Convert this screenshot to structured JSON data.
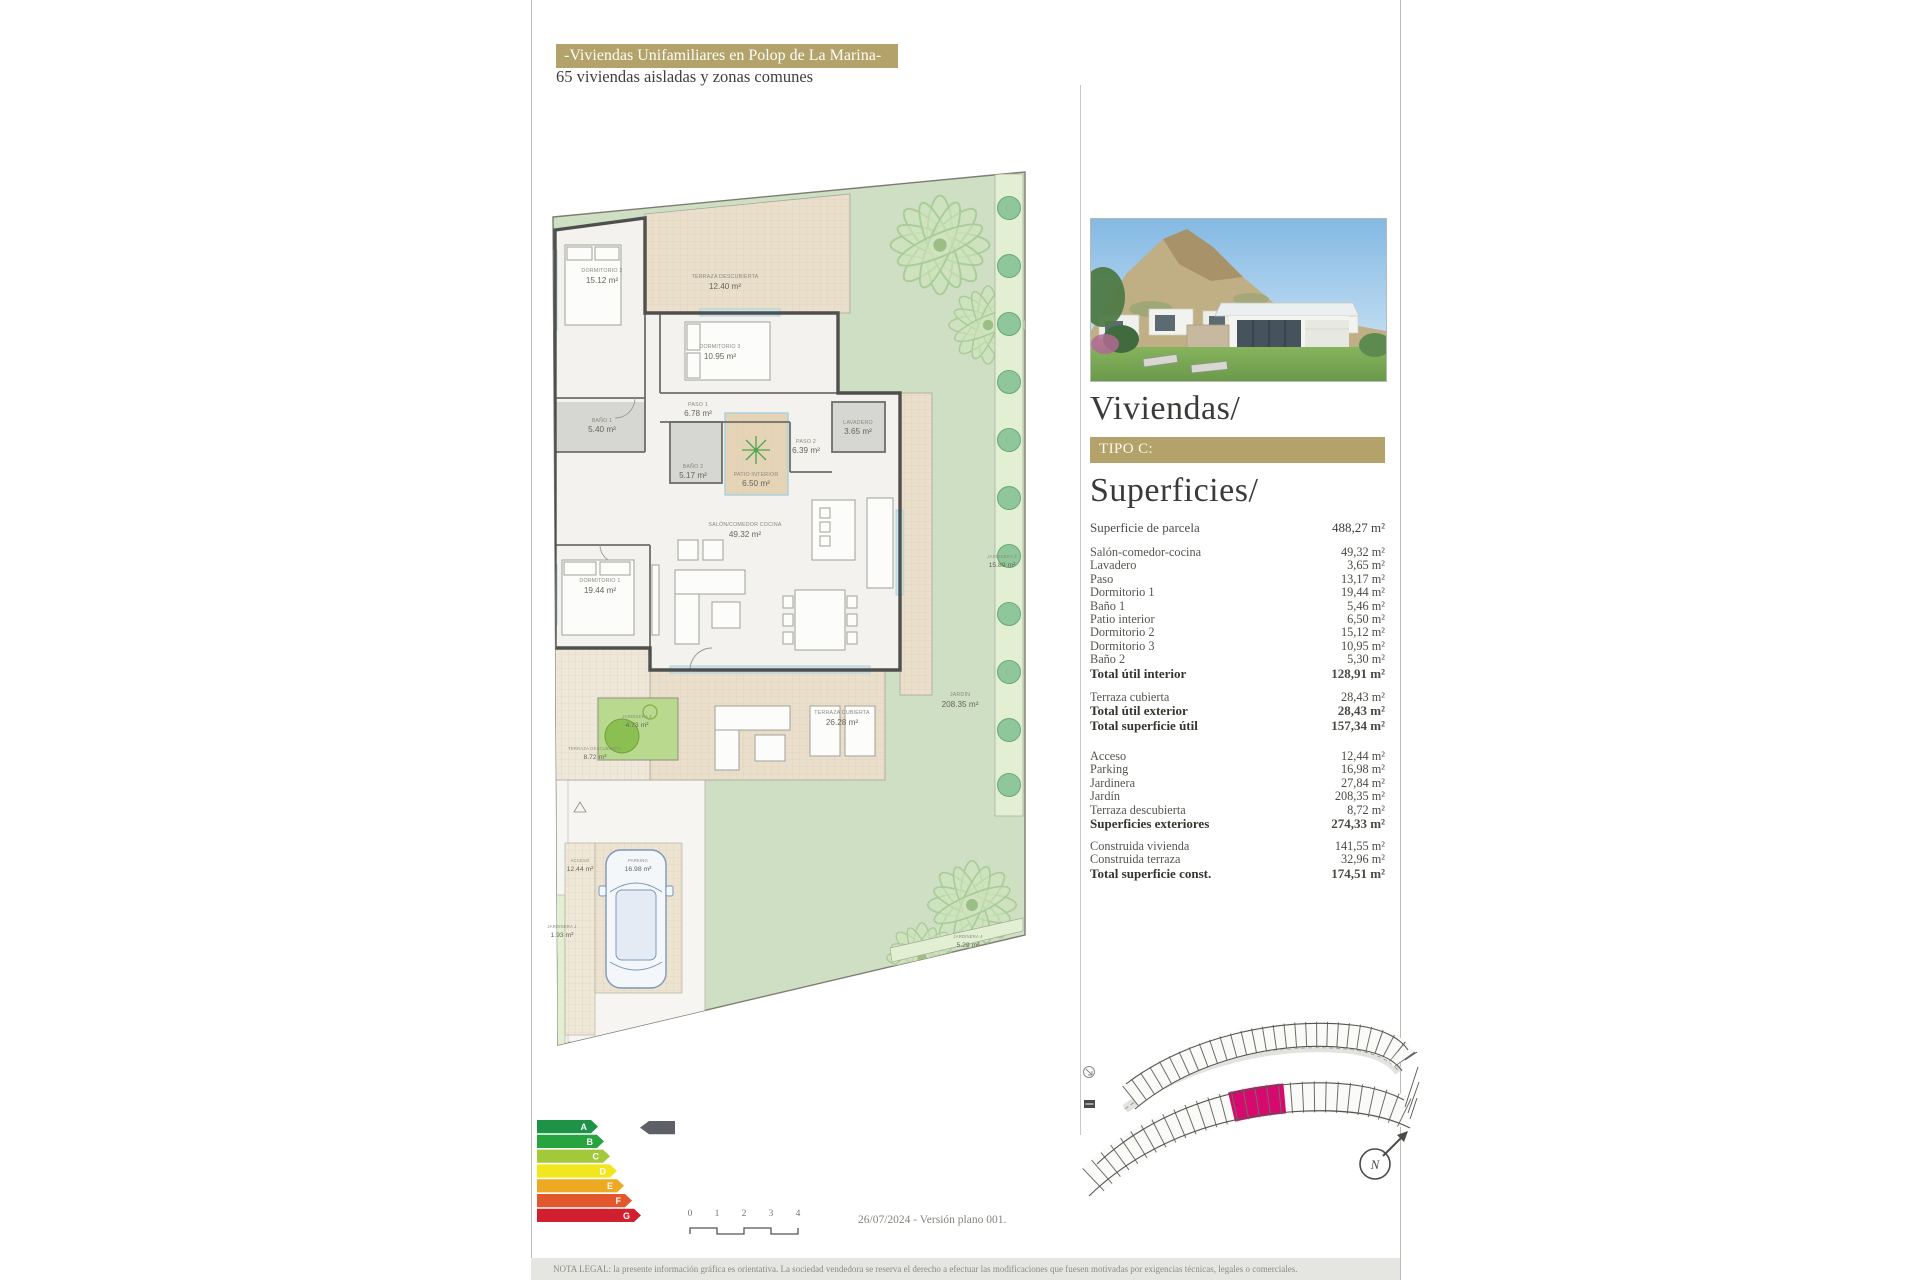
{
  "header": {
    "title": "-Viviendas Unifamiliares en Polop de La Marina-",
    "subtitle": "65 viviendas aisladas y zonas comunes"
  },
  "colors": {
    "brand_gold": "#b3a26a",
    "plot_highlight": "#d8096e",
    "garden_green": "#cfdfc3"
  },
  "right_panel": {
    "section_title": "Viviendas/",
    "type_badge": "TIPO C:",
    "surfaces_title": "Superficies/",
    "parcel_row": {
      "label": "Superficie de parcela",
      "value": "488,27 m²"
    },
    "interior_rows": [
      {
        "label": "Salón-comedor-cocina",
        "value": "49,32 m²"
      },
      {
        "label": "Lavadero",
        "value": "3,65 m²"
      },
      {
        "label": "Paso",
        "value": "13,17 m²"
      },
      {
        "label": "Dormitorio 1",
        "value": "19,44 m²"
      },
      {
        "label": "Baño 1",
        "value": "5,46 m²"
      },
      {
        "label": "Patio interior",
        "value": "6,50 m²"
      },
      {
        "label": "Dormitorio 2",
        "value": "15,12 m²"
      },
      {
        "label": "Dormitorio 3",
        "value": "10,95 m²"
      },
      {
        "label": "Baño 2",
        "value": "5,30 m²"
      },
      {
        "label": "Total útil interior",
        "value": "128,91 m²",
        "bold": true
      }
    ],
    "exterior_util_rows": [
      {
        "label": "Terraza cubierta",
        "value": "28,43 m²"
      },
      {
        "label": "Total útil exterior",
        "value": "28,43 m²",
        "bold": true
      },
      {
        "label": "Total superficie útil",
        "value": "157,34 m²",
        "bold": true
      }
    ],
    "exterior_rows": [
      {
        "label": "Acceso",
        "value": "12,44 m²"
      },
      {
        "label": "Parking",
        "value": "16,98 m²"
      },
      {
        "label": "Jardinera",
        "value": "27,84 m²"
      },
      {
        "label": "Jardín",
        "value": "208,35 m²"
      },
      {
        "label": "Terraza descubierta",
        "value": "8,72 m²"
      },
      {
        "label": "Superficies exteriores",
        "value": "274,33 m²",
        "bold": true
      }
    ],
    "built_rows": [
      {
        "label": "Construida vivienda",
        "value": "141,55 m²"
      },
      {
        "label": "Construida terraza",
        "value": "32,96 m²"
      },
      {
        "label": "Total superficie const.",
        "value": "174,51 m²",
        "bold": true
      }
    ]
  },
  "plan": {
    "rooms": [
      {
        "name": "DORMITORIO 2",
        "area": "15.12 m²"
      },
      {
        "name": "TERRAZA DESCUBIERTA",
        "area": "12.40 m²"
      },
      {
        "name": "DORMITORIO 3",
        "area": "10.95 m²"
      },
      {
        "name": "PASO 1",
        "area": "6.78 m²"
      },
      {
        "name": "BAÑO 1",
        "area": "5.40 m²"
      },
      {
        "name": "PASO 2",
        "area": "6.39 m²"
      },
      {
        "name": "LAVADERO",
        "area": "3.65 m²"
      },
      {
        "name": "BAÑO 2",
        "area": "5.17 m²"
      },
      {
        "name": "PATIO INTERIOR",
        "area": "6.50 m²"
      },
      {
        "name": "SALÓN/COMEDOR COCINA",
        "area": "49.32 m²"
      },
      {
        "name": "DORMITORIO 1",
        "area": "19.44 m²"
      },
      {
        "name": "JARDINERA 3",
        "area": "4.73 m²"
      },
      {
        "name": "TERRAZA DESCUBIERTA",
        "area": "8.72 m²"
      },
      {
        "name": "TERRAZA CUBIERTA",
        "area": "26.28 m²"
      },
      {
        "name": "JARDINERA 2",
        "area": "15.89 m²"
      },
      {
        "name": "JARDÍN",
        "area": "208.35 m²"
      },
      {
        "name": "ACCESO",
        "area": "12.44 m²"
      },
      {
        "name": "PARKING",
        "area": "16.98 m²"
      },
      {
        "name": "JARDINERA 1",
        "area": "1.93 m²"
      },
      {
        "name": "JARDINERA 4",
        "area": "5.29 m²"
      }
    ]
  },
  "site_plan": {
    "highlight_color": "#d8096e",
    "compass_letter": "N"
  },
  "energy": {
    "levels": [
      {
        "letter": "A",
        "color": "#1c9347"
      },
      {
        "letter": "B",
        "color": "#27a33f"
      },
      {
        "letter": "C",
        "color": "#a3c93a"
      },
      {
        "letter": "D",
        "color": "#f2e71f"
      },
      {
        "letter": "E",
        "color": "#eda921"
      },
      {
        "letter": "F",
        "color": "#e2572b"
      },
      {
        "letter": "G",
        "color": "#d11f2f"
      }
    ]
  },
  "scale_bar": {
    "ticks": [
      "0",
      "1",
      "2",
      "3",
      "4"
    ]
  },
  "footer": {
    "date_version": "26/07/2024 - Versión plano 001.",
    "legal": "NOTA LEGAL: la presente información gráfica es orientativa. La sociedad vendedora se reserva el derecho a efectuar las modificaciones que fuesen motivadas por exigencias técnicas, legales o comerciales."
  }
}
